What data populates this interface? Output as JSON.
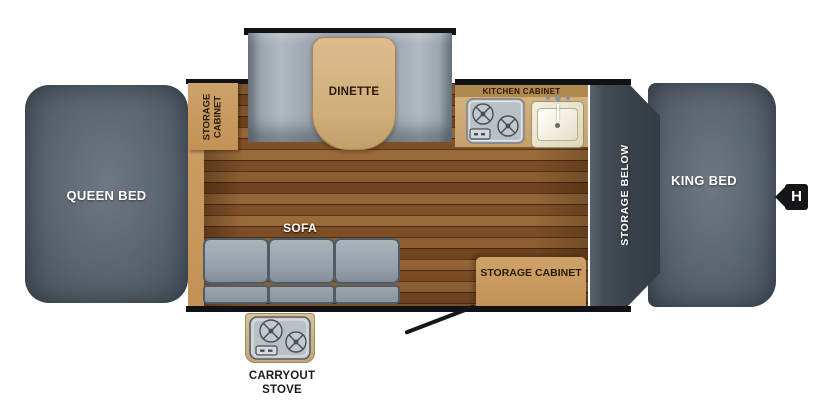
{
  "labels": {
    "queen_bed": "QUEEN BED",
    "storage_cabinet_front": "STORAGE CABINET",
    "dinette": "DINETTE",
    "sofa": "SOFA",
    "kitchen_cabinet": "KITCHEN CABINET",
    "storage_below": "STORAGE BELOW",
    "storage_cabinet_rear": "STORAGE CABINET",
    "king_bed": "KING BED",
    "carryout_stove": "CARRYOUT STOVE",
    "hitch": "H"
  },
  "icons": {
    "kitchen_stove": "stove-icon",
    "kitchen_sink": "sink-icon",
    "carryout_stove": "stove-icon",
    "hitch_marker": "hitch-marker",
    "door_swing": "door-swing-line"
  },
  "colors": {
    "bed_gray": "#57626c",
    "cushion_gray": "#9aa5ae",
    "cabinet_tan": "#c79a5e",
    "table_tan": "#d2b083",
    "wood_brown": "#86562c",
    "panel_charcoal": "#3f474f",
    "wall_black": "#111214",
    "label_dark": "#2b1a06",
    "label_light": "#ffffff"
  }
}
